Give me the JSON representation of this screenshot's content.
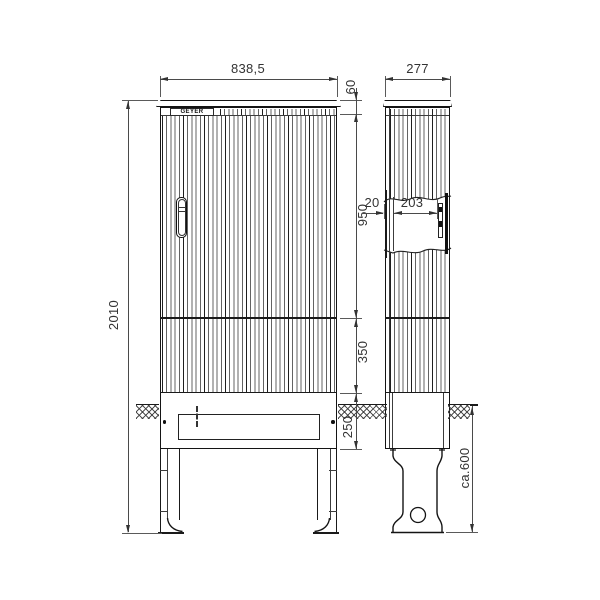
{
  "drawing": {
    "logo_text": "GEYER",
    "dims": {
      "front_width": "838,5",
      "side_depth": "277",
      "total_height": "2010",
      "top_height": "60",
      "upper_height": "950",
      "mid_height": "350",
      "base_height": "250",
      "door_thickness": "20",
      "inner_depth": "203",
      "underground_depth": "ca.600"
    },
    "colors": {
      "line": "#1a1a1a",
      "dim": "#4a4a4a",
      "background": "#ffffff"
    }
  }
}
